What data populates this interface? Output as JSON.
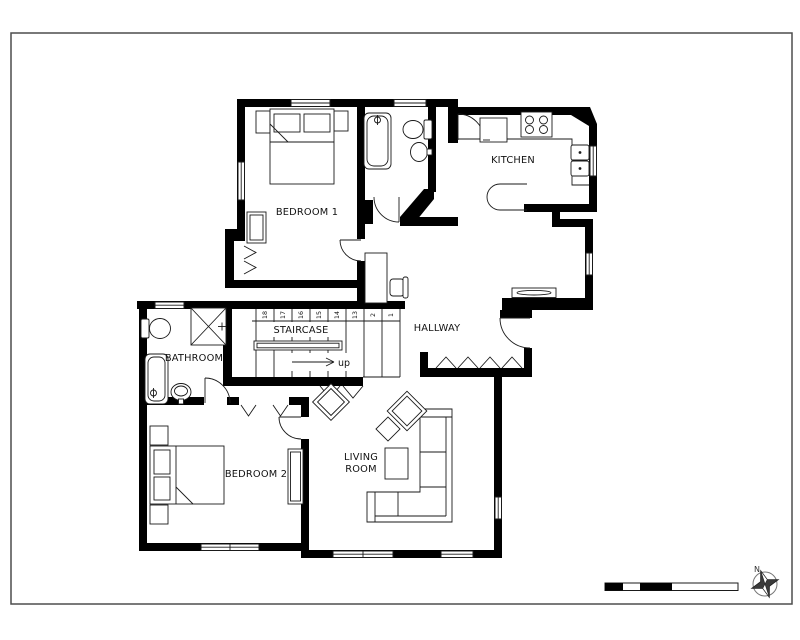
{
  "page": {
    "background": "#ffffff",
    "frame_color": "#4d4d4d"
  },
  "plan": {
    "wall_color": "#000000",
    "line_color": "#1a1a1a",
    "rooms": {
      "bedroom1": "BEDROOM 1",
      "kitchen": "KITCHEN",
      "hallway": "HALLWAY",
      "staircase": "STAIRCASE",
      "bathroom": "BATHROOM",
      "bedroom2": "BEDROOM 2",
      "living1": "LIVING",
      "living2": "ROOM"
    }
  },
  "staircase": {
    "steps": [
      "18",
      "17",
      "16",
      "15",
      "14",
      "13",
      "2",
      "1"
    ],
    "direction": "up"
  },
  "compass": {
    "north": "N",
    "fill": "#3a3a3a"
  }
}
